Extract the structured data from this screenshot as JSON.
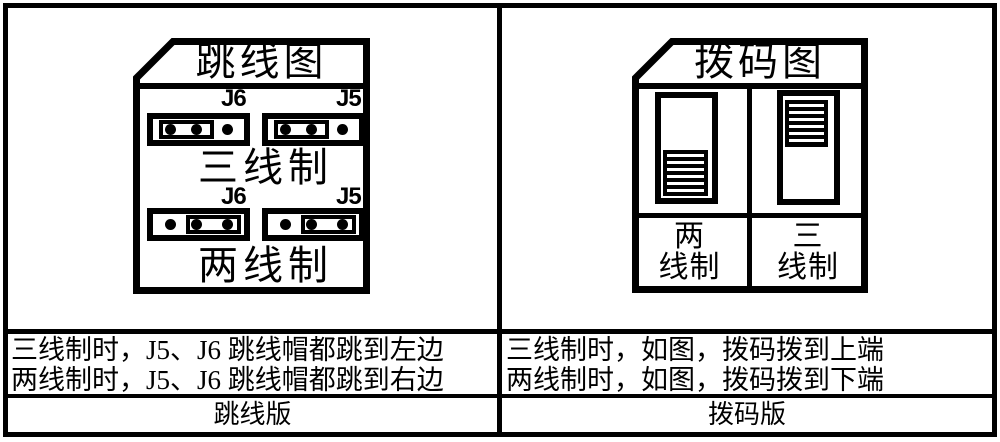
{
  "colors": {
    "line": "#000000",
    "background": "#ffffff"
  },
  "jumper_board": {
    "title": "跳线图",
    "three_wire": {
      "j6_label": "J6",
      "j5_label": "J5",
      "caption": "三线制"
    },
    "two_wire": {
      "j6_label": "J6",
      "j5_label": "J5",
      "caption": "两线制"
    },
    "note_line1": "三线制时，J5、J6 跳线帽都跳到左边",
    "note_line2": "两线制时，J5、J6 跳线帽都跳到右边",
    "version_label": "跳线版"
  },
  "dip_board": {
    "title": "拨码图",
    "two_wire_label_line1": "两",
    "two_wire_label_line2": "线制",
    "three_wire_label_line1": "三",
    "three_wire_label_line2": "线制",
    "note_line1": "三线制时，如图，拨码拨到上端",
    "note_line2": "两线制时，如图，拨码拨到下端",
    "version_label": "拨码版"
  }
}
